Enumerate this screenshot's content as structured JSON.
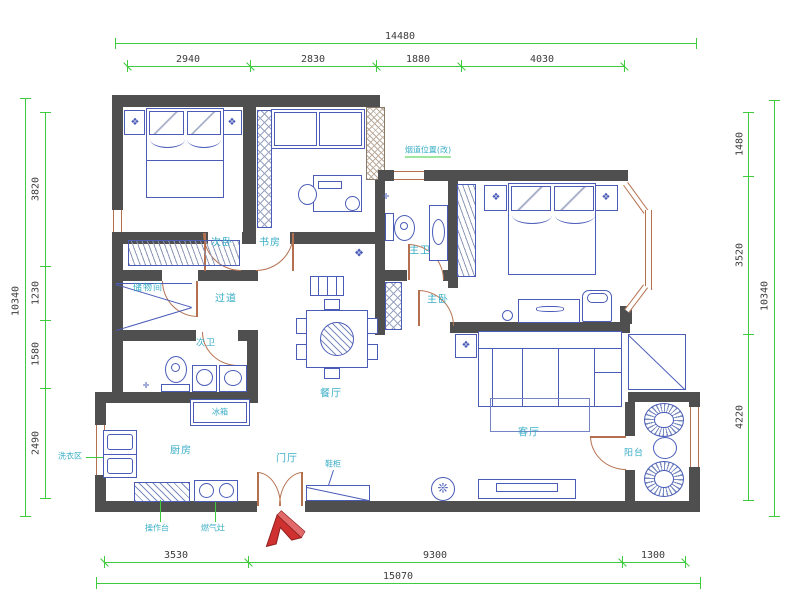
{
  "palette": {
    "wall": "#4f4f4f",
    "furniture": "#4a5cb8",
    "dimension": "#3ecc3e",
    "room_label": "#3aaec6",
    "door_window": "#b5714f",
    "entry_arrow": "#cf3030"
  },
  "dimensions": {
    "top": {
      "total": "14480",
      "segments": [
        "2940",
        "2830",
        "1880",
        "4030"
      ]
    },
    "bottom": {
      "total": "15070",
      "segments": [
        "3530",
        "9300",
        "1300"
      ]
    },
    "left": {
      "total": "10340",
      "segments": [
        "3820",
        "1230",
        "1580",
        "2490"
      ]
    },
    "right": {
      "total": "10340",
      "segments": [
        "1480",
        "3520",
        "4220"
      ]
    }
  },
  "rooms": {
    "bedroom2": "次卧",
    "study": "书房",
    "master_bath": "主卫",
    "master": "主卧",
    "storage": "储物间",
    "hallway": "过道",
    "second_bath": "次卫",
    "kitchen": "厨房",
    "foyer": "门厅",
    "dining": "餐厅",
    "living": "客厅",
    "balcony": "阳台"
  },
  "annotations": {
    "flue_note": "烟道位置(改)",
    "fridge": "冰箱",
    "counter": "操作台",
    "stove": "燃气灶",
    "laundry": "洗衣区",
    "shoe_cabinet": "鞋柜"
  },
  "symbols": {
    "flower": "❖",
    "fan": "❊",
    "drain": "✛"
  }
}
